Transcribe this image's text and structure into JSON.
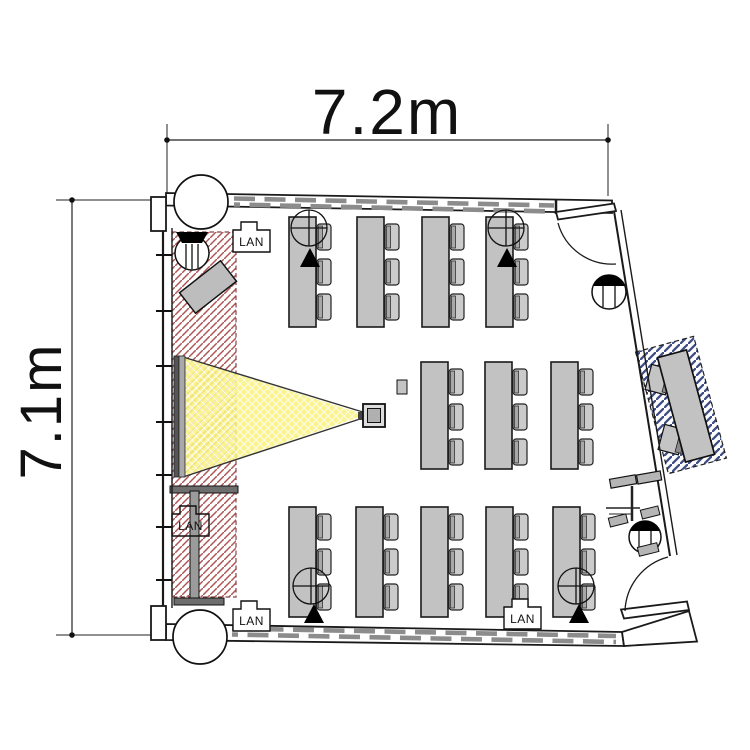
{
  "page": {
    "background": "#ffffff"
  },
  "diagram": {
    "type": "floor-plan",
    "room": {
      "width_label": "7.2m",
      "height_label": "7.1m"
    },
    "labels": {
      "lan_outlet": "LAN"
    },
    "summary": {
      "student_tables": 12,
      "seats_per_table": 3,
      "total_seats": 36,
      "lan_outlets": 4,
      "doors": 2,
      "columns": 2,
      "instructor_desks": 1
    },
    "furniture": {
      "table_rows": [
        {
          "name": "window-side-row",
          "y": 217,
          "h": 110,
          "w": 27,
          "xs": [
            289,
            357,
            422,
            486
          ]
        },
        {
          "name": "middle-row",
          "y": 362,
          "h": 107,
          "w": 27,
          "xs": [
            421,
            485,
            551
          ]
        },
        {
          "name": "corridor-side-row",
          "y": 507,
          "h": 110,
          "w": 27,
          "xs": [
            289,
            356,
            421,
            486,
            553
          ]
        }
      ],
      "chairs_per_table": 3,
      "chair": {
        "w": 14,
        "h": 26,
        "offsets": [
          7,
          42,
          77
        ]
      }
    },
    "lan_outlets": [
      {
        "x": 233,
        "y": 222,
        "transparent": false
      },
      {
        "x": 172,
        "y": 506,
        "transparent": true
      },
      {
        "x": 233,
        "y": 601,
        "transparent": false
      },
      {
        "x": 504,
        "y": 599,
        "transparent": false
      }
    ],
    "colors": {
      "line": "#1a1a1a",
      "table_fill": "#c2c2c2",
      "chair_fill": "#cbcbcb",
      "chair_back": "#a8a8a8",
      "window_dash": "#8c8c8c",
      "screen_zone_hatch": "#b05555",
      "screen_zone_border": "#8a4545",
      "beam_fill": "#f8f37d",
      "beam_grid": "#ffffff",
      "instructor_zone_hatch": "#3f4e86",
      "screen_dark": "#555555",
      "screen_light": "#a9a9a9",
      "stand_fill": "#6e6e6e",
      "pole_fill": "#9b9b9b",
      "lectern_fill": "#bdbdbd",
      "projector_fill": "#b0b0b0",
      "dim_text": "#111111"
    }
  }
}
